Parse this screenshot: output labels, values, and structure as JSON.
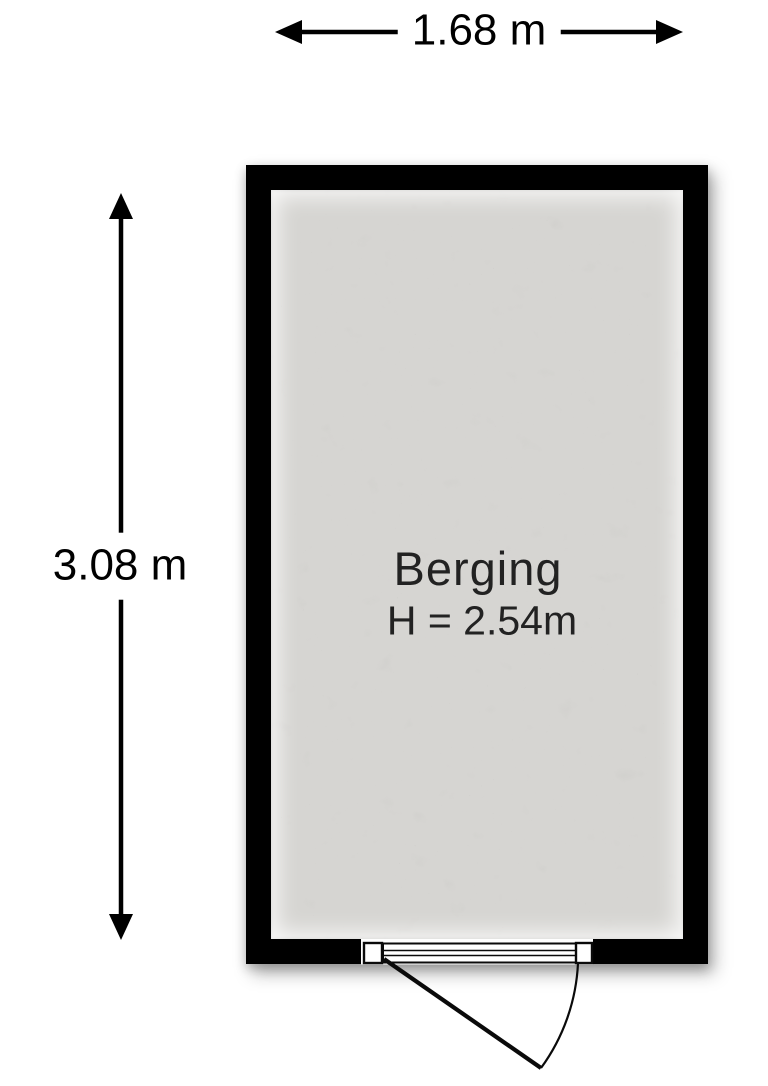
{
  "dimensions": {
    "width_label": "1.68 m",
    "height_label": "3.08 m"
  },
  "room": {
    "name": "Berging",
    "ceiling_height_label": "H = 2.54m"
  },
  "colors": {
    "background": "#ffffff",
    "wall": "#000000",
    "dimension": "#000000",
    "room_text": "#222222",
    "floor_base": "#d6d5d2",
    "floor_speckle": "#8c8c85",
    "door_line": "#0a0a0a"
  }
}
